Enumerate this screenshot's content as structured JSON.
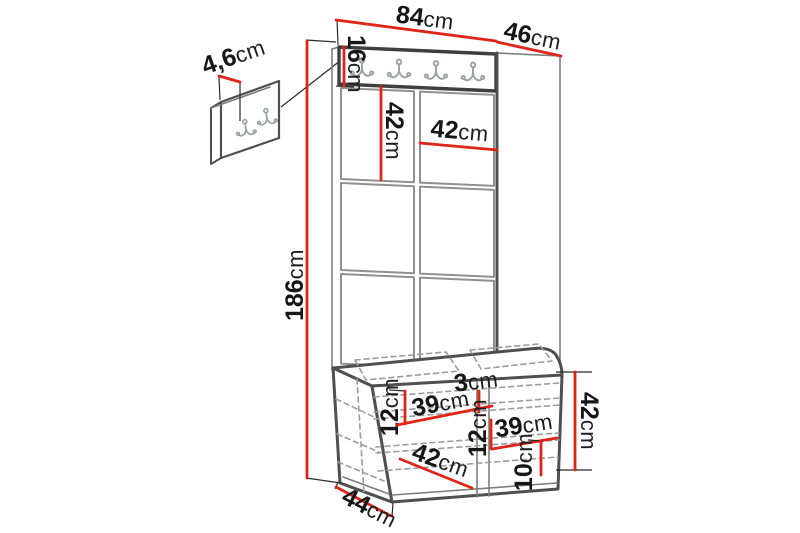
{
  "diagram": {
    "kind": "furniture-dimension-diagram",
    "subject": "hallway set: wall hook panel, upholstered panel wardrobe with hook rail and storage bench"
  },
  "colors": {
    "dimension_line": "#e02417",
    "outline_dark": "#4f4f4f",
    "outline_light": "#9c9c9c",
    "text": "#161616",
    "background": "#ffffff"
  },
  "icons": {
    "double_hook": "double-coat-hook-outline"
  },
  "dimensions": {
    "panel_width_top": {
      "value": "84",
      "unit": "cm"
    },
    "panel_depth_top": {
      "value": "46",
      "unit": "cm"
    },
    "hook_rail_height": {
      "value": "16",
      "unit": "cm"
    },
    "cushion_height": {
      "value": "42",
      "unit": "cm"
    },
    "cushion_width": {
      "value": "42",
      "unit": "cm"
    },
    "total_height": {
      "value": "186",
      "unit": "cm"
    },
    "seat_gap": {
      "value": "3",
      "unit": "cm"
    },
    "left_inner_height": {
      "value": "12",
      "unit": "cm"
    },
    "left_inner_width": {
      "value": "39",
      "unit": "cm"
    },
    "middle_inner_height": {
      "value": "12",
      "unit": "cm"
    },
    "right_inner_width": {
      "value": "39",
      "unit": "cm"
    },
    "bench_height": {
      "value": "42",
      "unit": "cm"
    },
    "door_diagonal_width": {
      "value": "42",
      "unit": "cm"
    },
    "bottom_clearance": {
      "value": "10",
      "unit": "cm"
    },
    "bench_depth": {
      "value": "44",
      "unit": "cm"
    },
    "small_panel_thickness": {
      "value": "4,6",
      "unit": "cm"
    }
  }
}
